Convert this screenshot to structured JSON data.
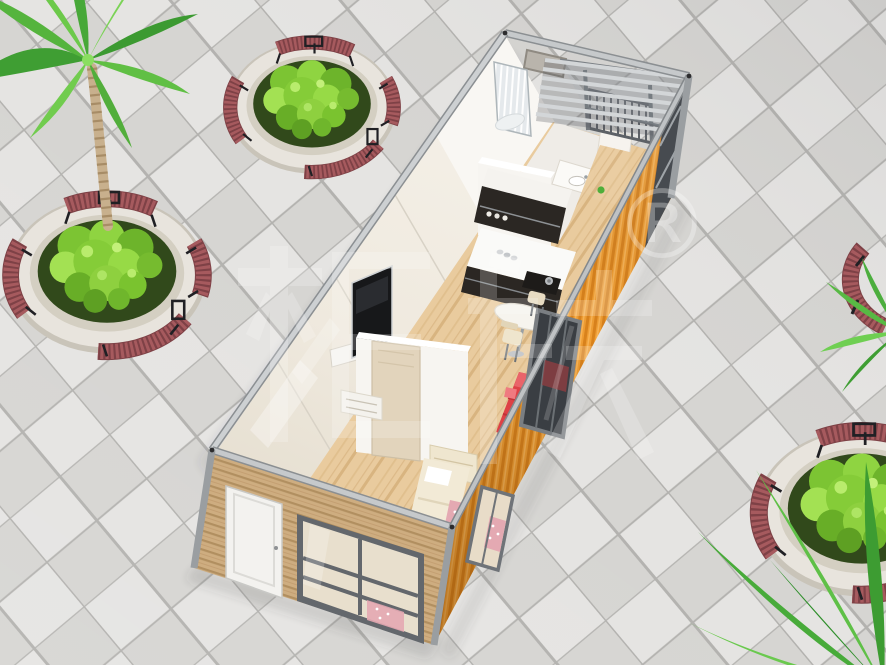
{
  "image": {
    "width_px": "886",
    "height_px": "665",
    "type": "3D architectural render",
    "subject": "Aerial cutaway view of a single-module container house interior on a tiled plaza with palm trees and circular stone planters with curved bench seating"
  },
  "watermark": {
    "cjk_text": "柜族",
    "registered_symbol": "®",
    "color": "#ffffff"
  },
  "palette": {
    "tile_light": "#e5e4e2",
    "tile_dark": "#d6d5d2",
    "tile_grout": "#b3b2af",
    "container_orange": "#ef9d33",
    "container_orange_dark": "#d9821c",
    "frame_silver": "#c6c9cb",
    "frame_shadow": "#8b8f92",
    "wood_siding": "#d8b88c",
    "interior_wall_cream": "#f2ede4",
    "wood_floor": "#e9cb9e",
    "partition_white": "#f7f5f1",
    "cabinet_dark": "#2b2723",
    "countertop_white": "#fafaf8",
    "sofa_red": "#dd4146",
    "bed_cream": "#f2ead6",
    "accent_pink": "#e4a9b2",
    "bench_wood_red": "#a65a5e",
    "bench_frame_black": "#202024",
    "planter_stone": "#e8e4dd",
    "foliage_light": "#8fd441",
    "foliage_dark": "#3f9e33",
    "palm_trunk": "#c8b08d",
    "glass_dark": "#474b50"
  },
  "scene": {
    "objects": [
      {
        "name": "tiled-plaza-floor",
        "label": "checkered stone plaza tiles"
      },
      {
        "name": "palm-tree-top-left",
        "label": "tall palm tree"
      },
      {
        "name": "planter-top",
        "label": "round stone planter with curved red benches"
      },
      {
        "name": "planter-left",
        "label": "round stone planter with palm trunk and benches"
      },
      {
        "name": "planter-bottom-right",
        "label": "round stone planter with curved red bench (partial)"
      },
      {
        "name": "bench-right-edge",
        "label": "curved red bench (partial at edge)"
      },
      {
        "name": "palm-bottom-right",
        "label": "palm fronds in corner"
      },
      {
        "name": "container-house",
        "label": "container home cutaway: bathroom with shower, glazed balcony, kitchen with bar, living area with TV and red sofa, bedroom with bed"
      },
      {
        "name": "watermark",
        "label": "translucent brand watermark with registered trademark symbol"
      }
    ]
  }
}
